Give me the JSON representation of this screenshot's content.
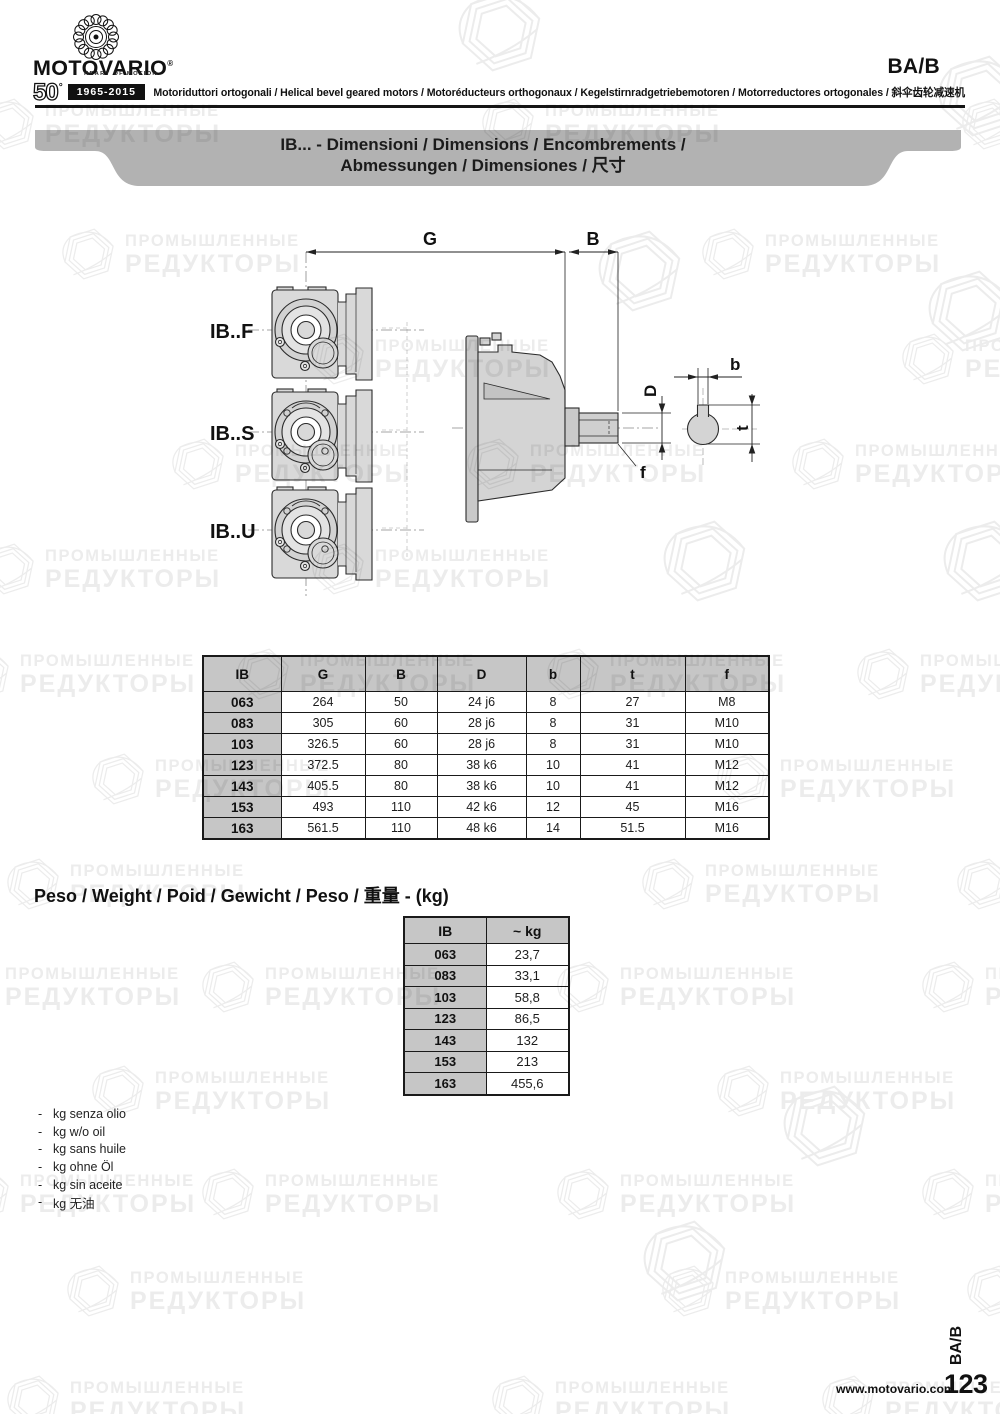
{
  "header": {
    "brand": "MOTOVARIO",
    "brand_mark": "®",
    "tagline": "HEART OF MOTION",
    "anniversary_number": "50",
    "anniversary_symbol": "°",
    "anniversary_years": "1965-2015",
    "section_code": "BA/B",
    "product_line": "Motoriduttori ortogonali / Helical bevel geared motors / Motoréducteurs orthogonaux / Kegelstirnradgetriebemotoren / Motorreductores ortogonales / 斜伞齿轮减速机"
  },
  "banner": {
    "title_line1": "IB... - Dimensioni / Dimensions / Encombrements /",
    "title_line2": "Abmessungen / Dimensiones / 尺寸"
  },
  "drawing": {
    "variant_labels": [
      "IB..F",
      "IB..S",
      "IB..U"
    ],
    "dimension_labels": {
      "overall_length": "G",
      "shaft_length": "B",
      "shaft_diameter": "D",
      "key_width": "b",
      "key_depth": "t",
      "thread": "f"
    }
  },
  "dimensions_table": {
    "headers": [
      "IB",
      "G",
      "B",
      "D",
      "b",
      "t",
      "f"
    ],
    "rows": [
      [
        "063",
        "264",
        "50",
        "24 j6",
        "8",
        "27",
        "M8"
      ],
      [
        "083",
        "305",
        "60",
        "28 j6",
        "8",
        "31",
        "M10"
      ],
      [
        "103",
        "326.5",
        "60",
        "28 j6",
        "8",
        "31",
        "M10"
      ],
      [
        "123",
        "372.5",
        "80",
        "38 k6",
        "10",
        "41",
        "M12"
      ],
      [
        "143",
        "405.5",
        "80",
        "38 k6",
        "10",
        "41",
        "M12"
      ],
      [
        "153",
        "493",
        "110",
        "42 k6",
        "12",
        "45",
        "M16"
      ],
      [
        "163",
        "561.5",
        "110",
        "48 k6",
        "14",
        "51.5",
        "M16"
      ]
    ]
  },
  "weight_section": {
    "title": "Peso / Weight / Poid / Gewicht / Peso / 重量 - (kg)",
    "table": {
      "headers": [
        "IB",
        "~ kg"
      ],
      "rows": [
        [
          "063",
          "23,7"
        ],
        [
          "083",
          "33,1"
        ],
        [
          "103",
          "58,8"
        ],
        [
          "123",
          "86,5"
        ],
        [
          "143",
          "132"
        ],
        [
          "153",
          "213"
        ],
        [
          "163",
          "455,6"
        ]
      ]
    }
  },
  "notes": [
    "kg senza olio",
    "kg w/o oil",
    "kg sans huile",
    "kg ohne Öl",
    "kg sin aceite",
    "kg 无油"
  ],
  "footer": {
    "website": "www.motovario.com",
    "page_number": "123",
    "section_code": "BA/B"
  },
  "watermark": {
    "line1": "ПРОМЫШЛЕННЫЕ",
    "line2": "РЕДУКТОРЫ"
  }
}
